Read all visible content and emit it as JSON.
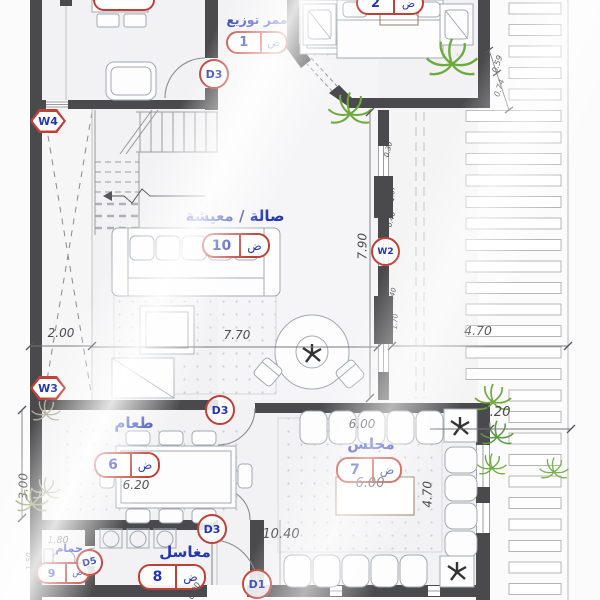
{
  "colors": {
    "wall": "#4a4a4c",
    "accent_red": "#c04038",
    "label_blue": "#2336b4",
    "plant_green": "#6faa3e",
    "dim_gray": "#4b4b4e"
  },
  "rooms": {
    "corridor": {
      "name": "ممر توزيع",
      "num": "1",
      "suf": "ض"
    },
    "living": {
      "name": "صالة / معيشة",
      "num": "10",
      "suf": "ض"
    },
    "dining": {
      "name": "طعام",
      "num": "6",
      "suf": "ض"
    },
    "majlis": {
      "name": "مجلس",
      "num": "7",
      "suf": "ض"
    },
    "sinks": {
      "name": "مغاسل",
      "num": "8",
      "suf": "ض"
    },
    "bath": {
      "name": "حمام",
      "num": "9",
      "suf": "ض"
    },
    "bedroom": {
      "num": "2",
      "suf": "ض"
    }
  },
  "doors": {
    "d3a": "D3",
    "d3b": "D3",
    "d3c": "D3",
    "d5": "D5",
    "d1": "D1"
  },
  "windows": {
    "w4": "W4",
    "w3": "W3",
    "w2": "W2"
  },
  "dims": {
    "w200": "2.00",
    "w770": "7.70",
    "w470top": "4.70",
    "w220": "2.20",
    "h790": "7.90",
    "h300": "3.00",
    "t620": "6.20",
    "m600a": "6.00",
    "m600b": "6.00",
    "h470": "4.70",
    "w1040": "10.40",
    "b180": "1.80",
    "b150": "1.50",
    "b280": "2.80",
    "b090": "0.90",
    "p059": "0.59",
    "p074": "0.74",
    "s030": "0.30",
    "s167": "1.67",
    "s040a": "0.40",
    "s040b": "0.40",
    "s170": "1.70"
  }
}
